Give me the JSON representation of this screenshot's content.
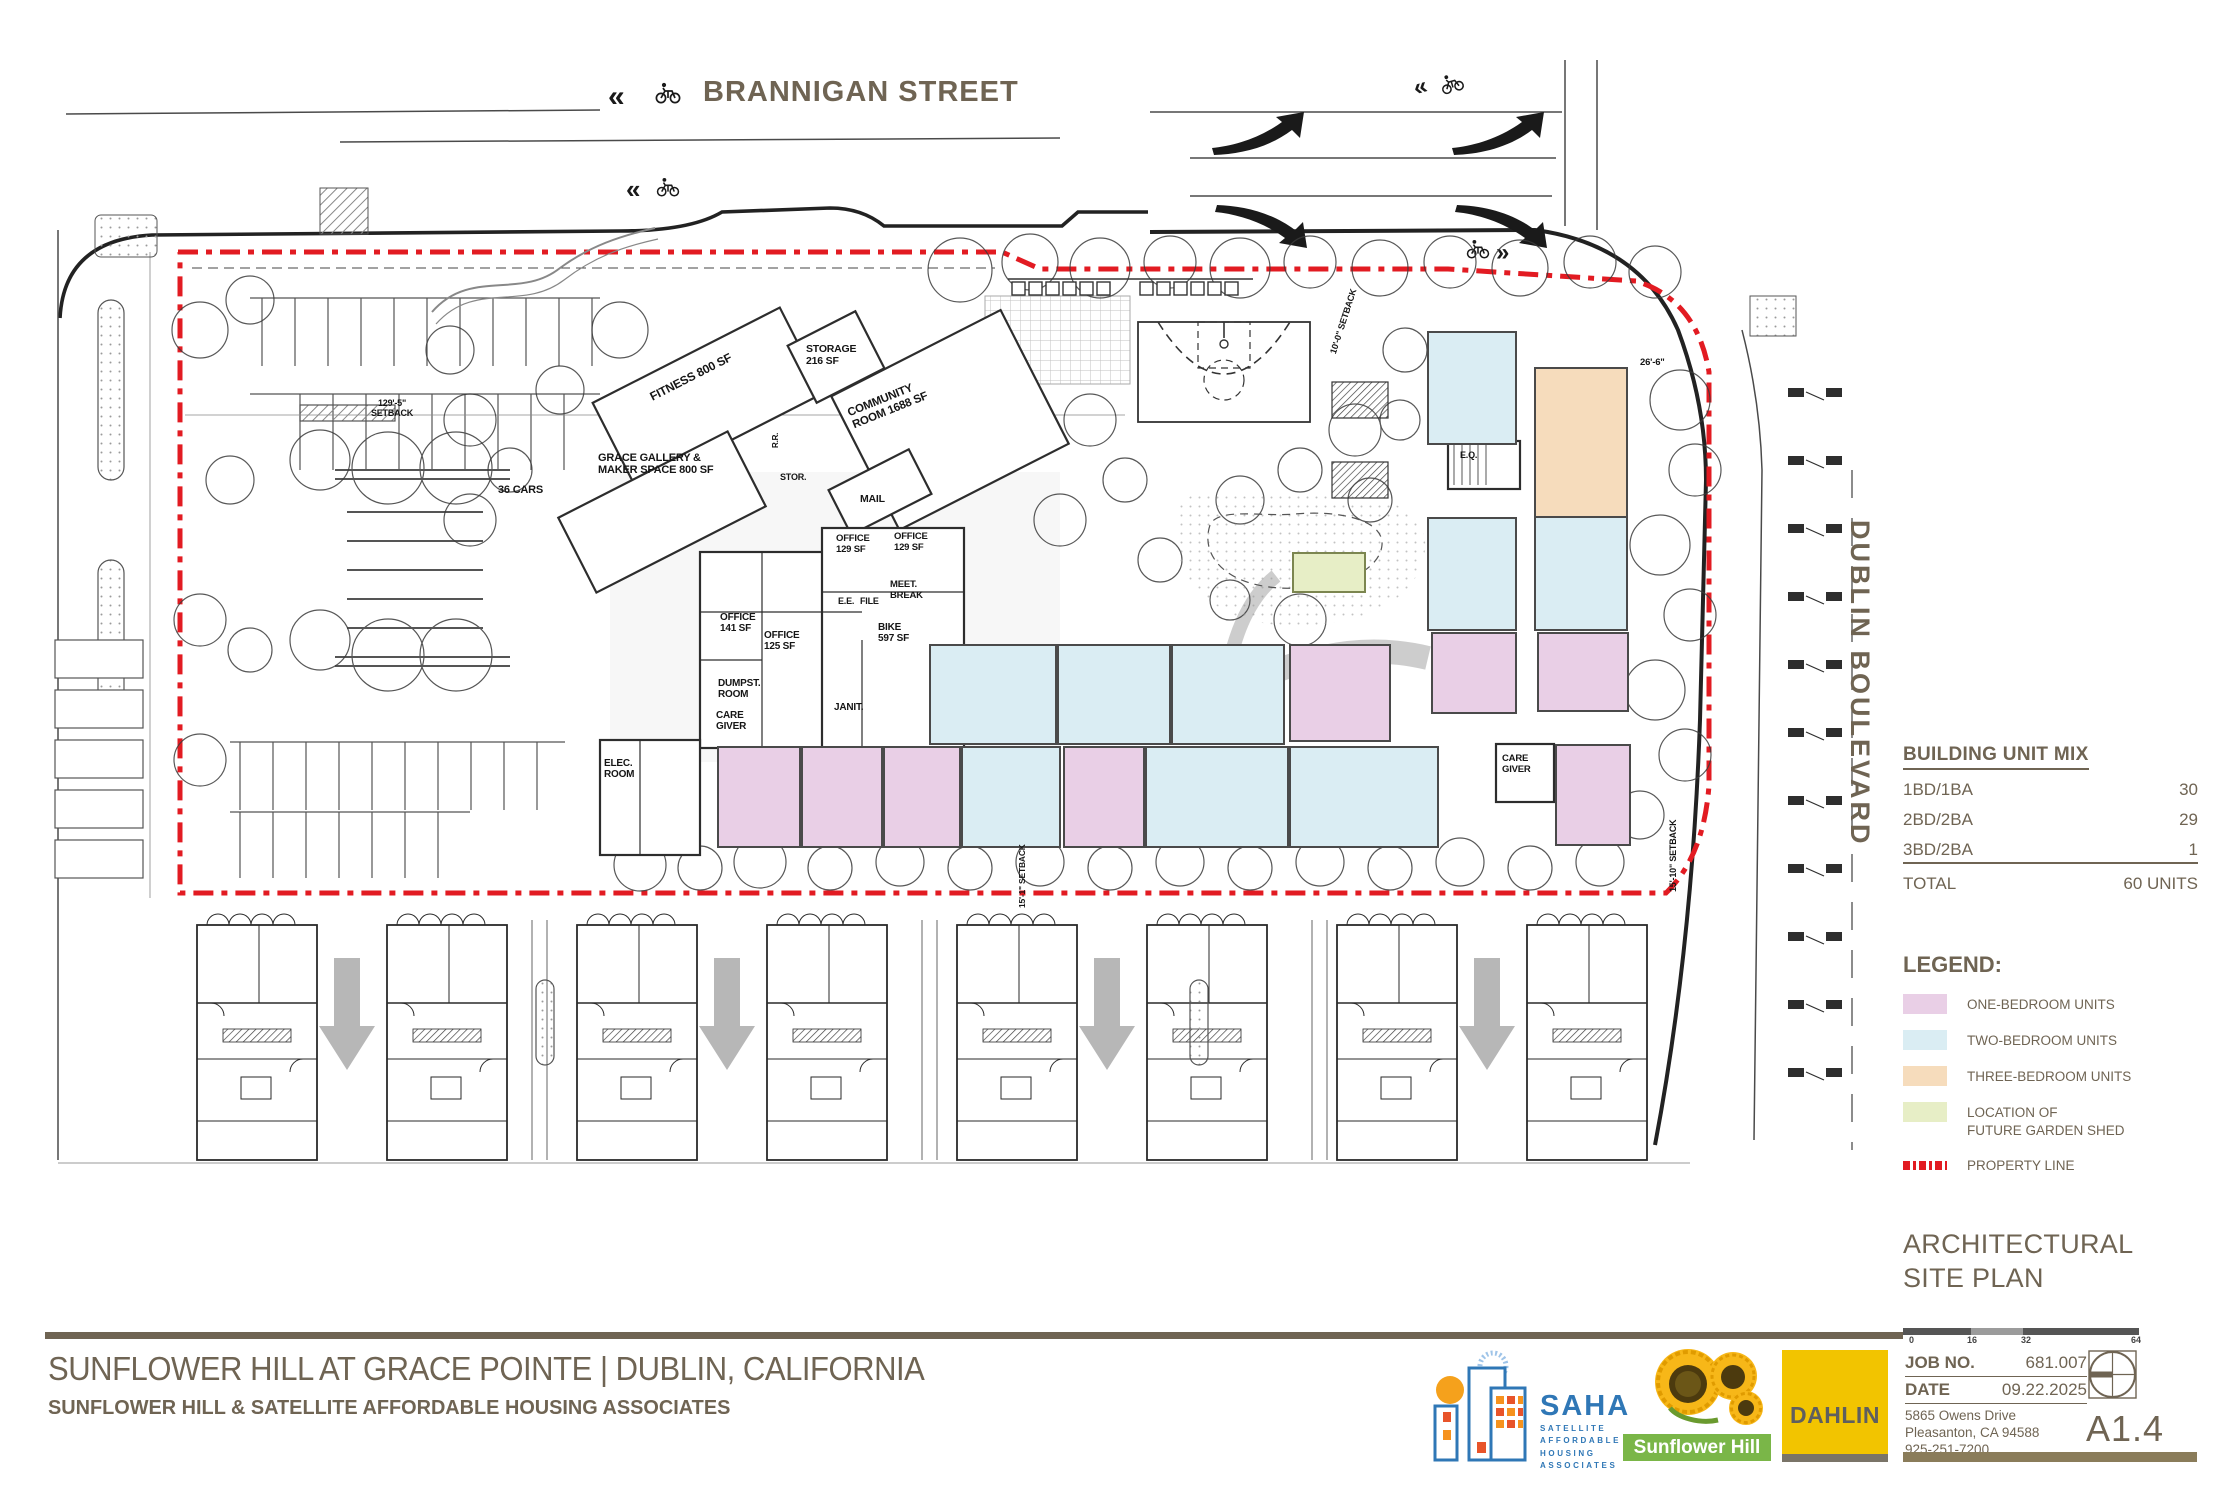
{
  "streets": {
    "brannigan": "BRANNIGAN STREET",
    "dublin": "DUBLIN BOULEVARD"
  },
  "plan": {
    "rooms": [
      "FITNESS 800 SF",
      "STORAGE\n216 SF",
      "COMMUNITY\nROOM 1688 SF",
      "GRACE GALLERY &\nMAKER SPACE 800 SF",
      "MAIL",
      "OFFICE\n129 SF",
      "OFFICE\n129 SF",
      "MEET.\nBREAK",
      "E.E.",
      "FILE",
      "OFFICE\n141 SF",
      "OFFICE\n125 SF",
      "BIKE\n597 SF",
      "DUMPST.\nROOM",
      "JANIT.",
      "CARE\nGIVER",
      "ELEC.\nROOM",
      "CARE\nGIVER",
      "E.Q.",
      "STOR.",
      "R.R.",
      "36 CARS"
    ],
    "dims": [
      "129'-5\"\nSETBACK",
      "10'-0\" SETBACK",
      "26'-6\"",
      "15'-10\" SETBACK",
      "15'-1\" SETBACK"
    ]
  },
  "unit_mix": {
    "title": "BUILDING UNIT MIX",
    "rows": [
      {
        "label": "1BD/1BA",
        "value": "30"
      },
      {
        "label": "2BD/2BA",
        "value": "29"
      },
      {
        "label": "3BD/2BA",
        "value": "1"
      }
    ],
    "total_label": "TOTAL",
    "total_value": "60 UNITS"
  },
  "legend": {
    "title": "LEGEND:",
    "items": [
      {
        "label": "ONE-BEDROOM UNITS",
        "color": "#e9cfe6"
      },
      {
        "label": "TWO-BEDROOM UNITS",
        "color": "#daedf3"
      },
      {
        "label": "THREE-BEDROOM UNITS",
        "color": "#f6dcbc"
      },
      {
        "label": "LOCATION OF\nFUTURE GARDEN SHED",
        "color": "#e7eec6"
      },
      {
        "label": "PROPERTY LINE",
        "color": "#e21b22"
      }
    ]
  },
  "sheet": {
    "name_line1": "ARCHITECTURAL",
    "name_line2": "SITE PLAN",
    "scale": [
      "0",
      "16",
      "32",
      "64"
    ],
    "job_no_label": "JOB NO.",
    "job_no": "681.007",
    "date_label": "DATE",
    "date": "09.22.2025",
    "address_line1": "5865 Owens Drive",
    "address_line2": "Pleasanton, CA 94588",
    "address_line3": "925-251-7200",
    "sheet_no": "A1.4"
  },
  "titleblock": {
    "project": "SUNFLOWER HILL AT GRACE POINTE  |  DUBLIN, CALIFORNIA",
    "client": "SUNFLOWER HILL & SATELLITE AFFORDABLE HOUSING ASSOCIATES"
  },
  "logos": {
    "saha": {
      "name": "SAHA",
      "sub1": "SATELLITE",
      "sub2": "AFFORDABLE",
      "sub3": "HOUSING",
      "sub4": "ASSOCIATES"
    },
    "sunflower": {
      "name": "Sunflower Hill"
    },
    "dahlin": {
      "name": "DAHLIN"
    }
  },
  "colors": {
    "text_brown": "#6f6453",
    "property_line_red": "#e21b22",
    "one_bedroom_pink": "#e9cfe6",
    "two_bedroom_blue": "#daedf3",
    "three_bedroom_peach": "#f6dcbc",
    "garden_shed_green": "#e7eec6",
    "dahlin_yellow": "#f2c400",
    "saha_blue": "#2f77b6",
    "sunflower_green": "#7ab648"
  }
}
